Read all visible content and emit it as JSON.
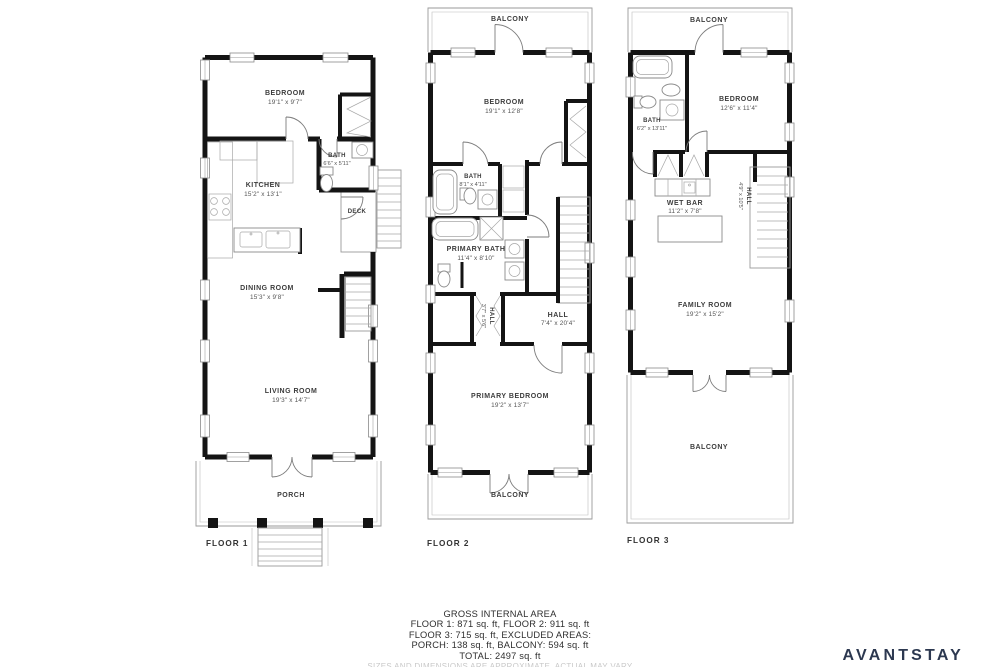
{
  "floors": {
    "f1": {
      "label": "FLOOR 1",
      "bedroom": {
        "name": "BEDROOM",
        "dims": "19'1\" x 9'7\""
      },
      "bath": {
        "name": "BATH",
        "dims": "6'6\" x 5'11\""
      },
      "kitchen": {
        "name": "KITCHEN",
        "dims": "15'2\" x 13'1\""
      },
      "deck": {
        "name": "DECK"
      },
      "dining_room": {
        "name": "DINING ROOM",
        "dims": "15'3\" x 9'8\""
      },
      "living_room": {
        "name": "LIVING ROOM",
        "dims": "19'3\" x 14'7\""
      },
      "porch": {
        "name": "PORCH"
      }
    },
    "f2": {
      "label": "FLOOR 2",
      "balcony_top": {
        "name": "BALCONY"
      },
      "bedroom": {
        "name": "BEDROOM",
        "dims": "19'1\" x 12'8\""
      },
      "bath": {
        "name": "BATH",
        "dims": "8'1\" x 4'11\""
      },
      "primary_bath": {
        "name": "PRIMARY BATH",
        "dims": "11'4\" x 8'10\""
      },
      "hall_closet": {
        "name": "HALL",
        "dims": "3'7\" x 5'6\""
      },
      "hall": {
        "name": "HALL",
        "dims": "7'4\" x 20'4\""
      },
      "primary_bedroom": {
        "name": "PRIMARY BEDROOM",
        "dims": "19'2\" x 13'7\""
      },
      "balcony_bottom": {
        "name": "BALCONY"
      }
    },
    "f3": {
      "label": "FLOOR 3",
      "balcony_top": {
        "name": "BALCONY"
      },
      "bath": {
        "name": "BATH",
        "dims": "6'2\" x 13'11\""
      },
      "bedroom": {
        "name": "BEDROOM",
        "dims": "12'6\" x 11'4\""
      },
      "wet_bar": {
        "name": "WET BAR",
        "dims": "11'2\" x 7'8\""
      },
      "hall": {
        "name": "HALL",
        "dims": "4'9\" x 10'5\""
      },
      "family_room": {
        "name": "FAMILY ROOM",
        "dims": "19'2\" x 15'2\""
      },
      "balcony_bottom": {
        "name": "BALCONY"
      }
    }
  },
  "summary": {
    "title": "GROSS INTERNAL AREA",
    "line1": "FLOOR 1: 871 sq. ft, FLOOR 2: 911 sq. ft",
    "line2": "FLOOR 3: 715 sq. ft, EXCLUDED AREAS:",
    "line3": "PORCH: 138 sq. ft, BALCONY: 594 sq. ft",
    "line4": "TOTAL: 2497 sq. ft",
    "disclaimer": "SIZES AND DIMENSIONS ARE APPROXIMATE, ACTUAL MAY VARY"
  },
  "brand": {
    "name": "AVANTSTAY",
    "color": "#2c3850"
  }
}
